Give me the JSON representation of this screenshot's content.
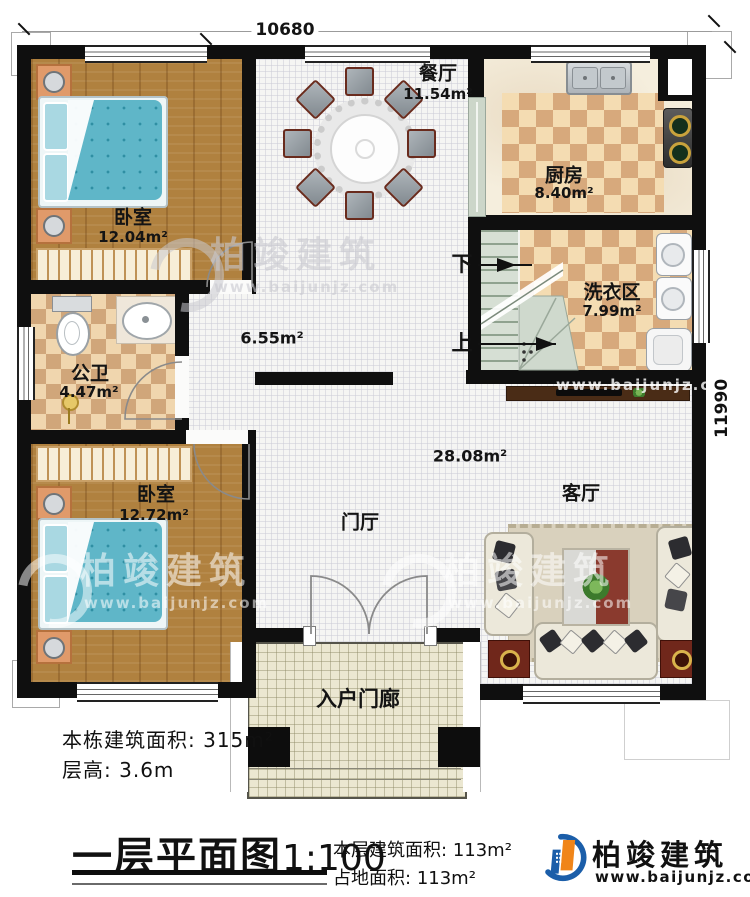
{
  "dimensions": {
    "top_width": "10680",
    "right_height": "11990"
  },
  "rooms": {
    "bedroom1": {
      "label": "卧室",
      "area": "12.04m²"
    },
    "dining": {
      "label": "餐厅",
      "area": "11.54m²"
    },
    "kitchen": {
      "label": "厨房",
      "area": "8.40m²"
    },
    "laundry": {
      "label": "洗衣区",
      "area": "7.99m²"
    },
    "bathroom": {
      "label": "公卫",
      "area": "4.47m²"
    },
    "bedroom2": {
      "label": "卧室",
      "area": "12.72m²"
    },
    "living": {
      "label": "客厅",
      "area": "28.08m²"
    },
    "foyer": {
      "label": "门厅"
    },
    "porch": {
      "label": "入户门廊"
    },
    "hall_area": "6.55m²"
  },
  "stairs": {
    "down_label": "下",
    "up_label": "上"
  },
  "footer": {
    "building_total_label": "本栋建筑面积:",
    "building_total_value": "315m²",
    "floor_height_label": "层高:",
    "floor_height_value": "3.6m",
    "plan_title": "一层平面图",
    "plan_scale": "1:100",
    "floor_area_label": "本层建筑面积:",
    "floor_area_value": "113m²",
    "footprint_label": "占地面积:",
    "footprint_value": "113m²"
  },
  "brand": {
    "name": "柏竣建筑",
    "website": "www.baijunjz.com"
  },
  "watermark": {
    "name": "柏竣建筑",
    "website": "www.baijunjz.com"
  },
  "colors": {
    "wall": "#0f0f0f",
    "wood_floor": "#b0813f",
    "tile_light": "#f4dcb2",
    "tile_dark": "#d7a97c",
    "bed_blanket": "#5fb6c8",
    "brand_orange": "#f08519",
    "brand_blue": "#1b5ea9",
    "accent_red": "#70271b"
  }
}
